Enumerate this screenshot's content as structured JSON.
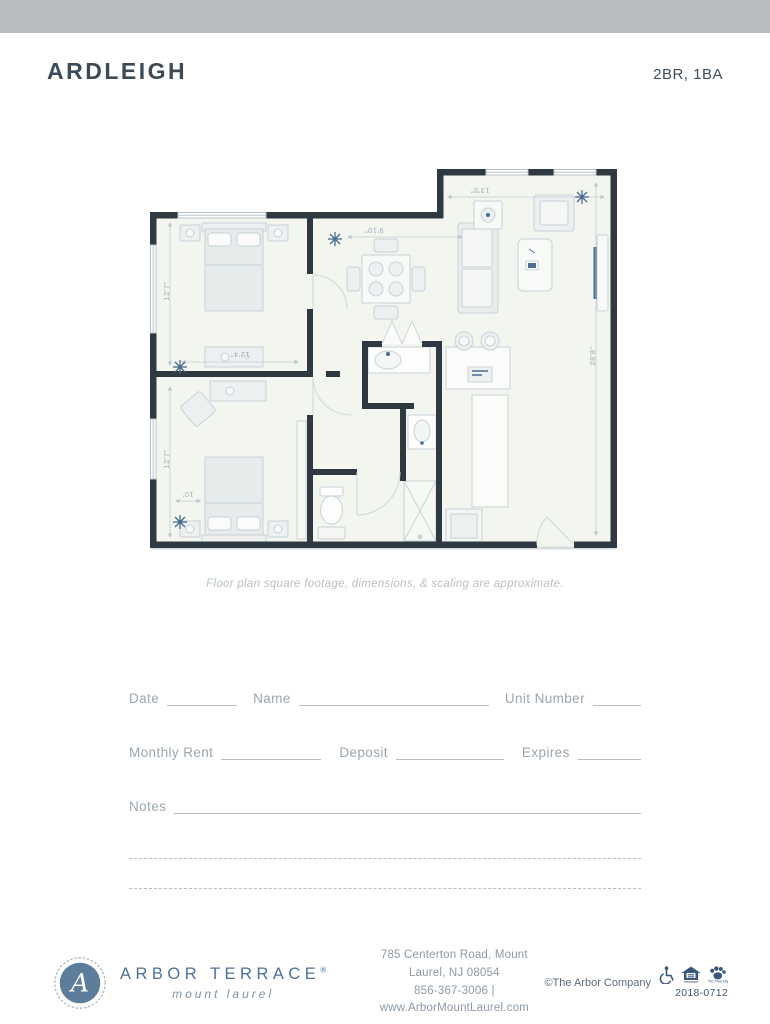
{
  "header": {
    "title": "ARDLEIGH",
    "unit_type": "2BR, 1BA"
  },
  "plan": {
    "caption": "Floor plan square footage, dimensions, & scaling are approximate.",
    "dims": {
      "bed1_h": "12'7\"",
      "bed1_w": "12'4\"",
      "bed2_h": "12'7\"",
      "bed2_w": "10'",
      "living_w": "13'5\"",
      "dining_w": "9'10\"",
      "unit_h": "28'8\""
    }
  },
  "form": {
    "date": "Date",
    "name": "Name",
    "unit_number": "Unit Number",
    "monthly_rent": "Monthly Rent",
    "deposit": "Deposit",
    "expires": "Expires",
    "notes": "Notes"
  },
  "footer": {
    "monogram": "A",
    "brand": "ARBOR TERRACE",
    "reg": "®",
    "tagline": "mount laurel",
    "address_line1": "785 Centerton Road, Mount Laurel, NJ 08054",
    "address_line2": "856-367-3006 | www.ArborMountLaurel.com",
    "copyright": "©The Arbor Company",
    "pet_label": "Pet Friendly",
    "code": "2018-0712"
  },
  "colors": {
    "accent_blue": "#4a6d91",
    "wall": "#2e3941",
    "brand_blue": "#5d7e9b",
    "bar_gray": "#b9bcbe"
  }
}
